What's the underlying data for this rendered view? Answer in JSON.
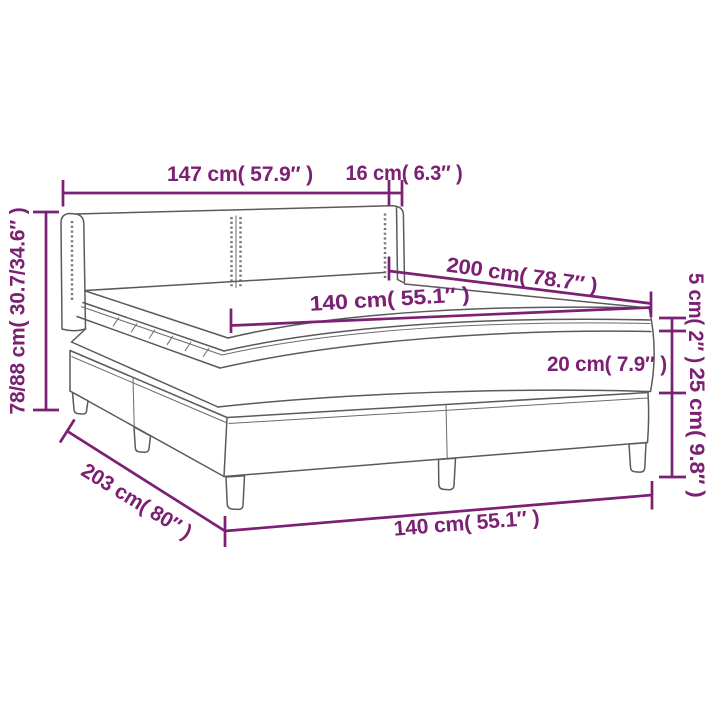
{
  "figure": {
    "type": "product-dimension-diagram",
    "subject": "box spring bed with headboard, mattress and topper"
  },
  "colors": {
    "dimension": "#7B2072",
    "outline": "#5A5A5E",
    "background": "#FFFFFF"
  },
  "labels": {
    "headboard_width": "147 cm( 57.9″ )",
    "headboard_side_depth": "16 cm( 6.3″ )",
    "overall_height": "78/88 cm( 30.7/34.6″ )",
    "mattress_length": "200 cm( 78.7″ )",
    "mattress_width": "140 cm( 55.1″ )",
    "topper_height": "5 cm( 2″ )",
    "mattress_height": "20 cm( 7.9″ )",
    "base_height": "25 cm( 9.8″ )",
    "base_length": "203 cm( 80″ )",
    "base_width": "140 cm( 55.1″ )"
  }
}
